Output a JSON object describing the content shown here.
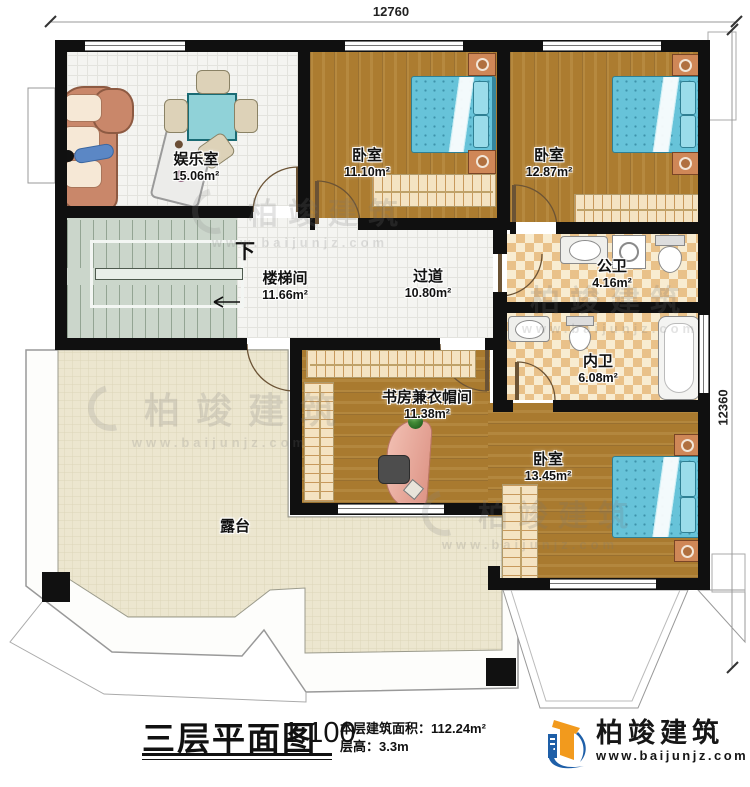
{
  "dimensions": {
    "top": "12760",
    "right": "12360"
  },
  "rooms": [
    {
      "name": "娱乐室",
      "area": "15.06m²"
    },
    {
      "name": "卧室",
      "area": "11.10m²"
    },
    {
      "name": "卧室",
      "area": "12.87m²"
    },
    {
      "name": "公卫",
      "area": "4.16m²"
    },
    {
      "name": "楼梯间",
      "area": "11.66m²"
    },
    {
      "name": "过道",
      "area": "10.80m²"
    },
    {
      "name": "内卫",
      "area": "6.08m²"
    },
    {
      "name": "书房兼衣帽间",
      "area": "11.38m²"
    },
    {
      "name": "卧室",
      "area": "13.45m²"
    },
    {
      "name": "露台",
      "area": ""
    }
  ],
  "stairs": {
    "down_label": "下"
  },
  "title_block": {
    "title": "三层平面图",
    "scale": "1:100",
    "floor_area_label": "本层建筑面积：",
    "floor_area_value": "112.24m²",
    "floor_height_label": "层高：",
    "floor_height_value": "3.3m"
  },
  "logo": {
    "company": "柏竣建筑",
    "website": "www.baijunjz.com"
  },
  "watermark": {
    "text": "柏竣建筑",
    "subtext": "www.baijunjz.com"
  },
  "colors": {
    "wall": "#101010",
    "wood": "#ac7c30",
    "bed_blue": "#67c3d9",
    "terrace": "#ece6cf",
    "tile": "#e9c189",
    "stair": "#cbd6cb",
    "logo_blue": "#1e5fa8",
    "logo_orange": "#f29a1d"
  }
}
